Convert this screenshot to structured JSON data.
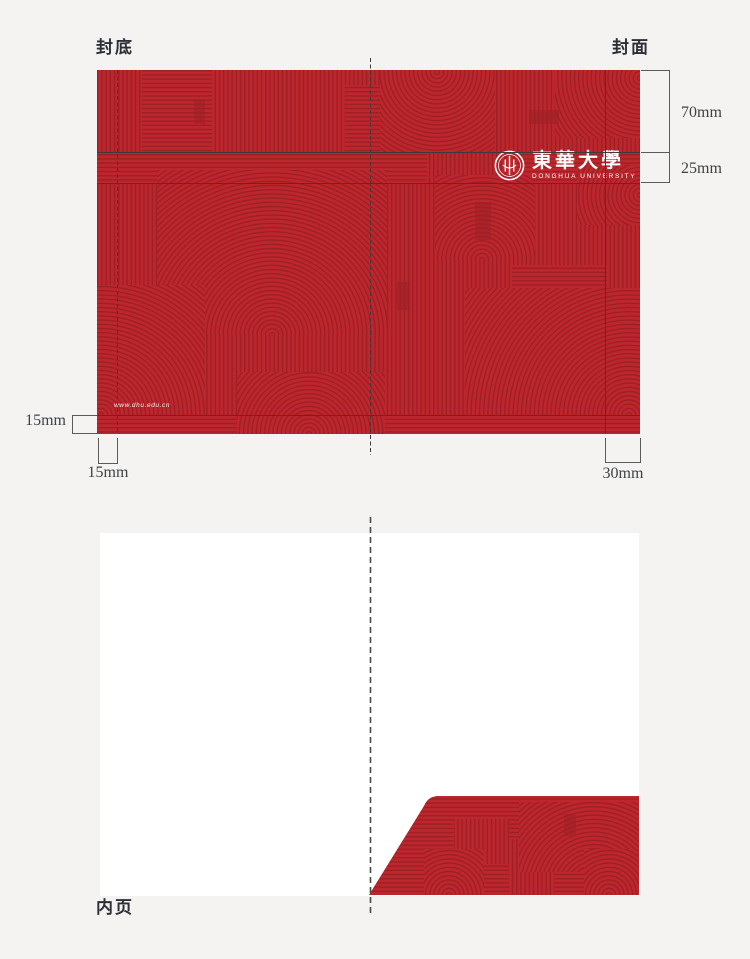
{
  "colors": {
    "background": "#f4f3f1",
    "red_base": "#bd262c",
    "red_line": "#9d2026",
    "guide_line": "#3e3a38",
    "annotation_text": "#3e4247",
    "label_text": "#2c2f36",
    "white": "#ffffff"
  },
  "top_section": {
    "back_cover_label": "封底",
    "front_cover_label": "封面",
    "dimensions": {
      "cover_top_height": "70mm",
      "logo_band_height": "25mm",
      "bottom_margin": "15mm",
      "left_margin": "15mm",
      "right_margin": "30mm"
    }
  },
  "cover": {
    "logo_cn": "東華大學",
    "logo_en": "DONGHUA UNIVERSITY",
    "website": "www.dhu.edu.cn"
  },
  "bottom_section": {
    "inner_page_label": "内页"
  }
}
